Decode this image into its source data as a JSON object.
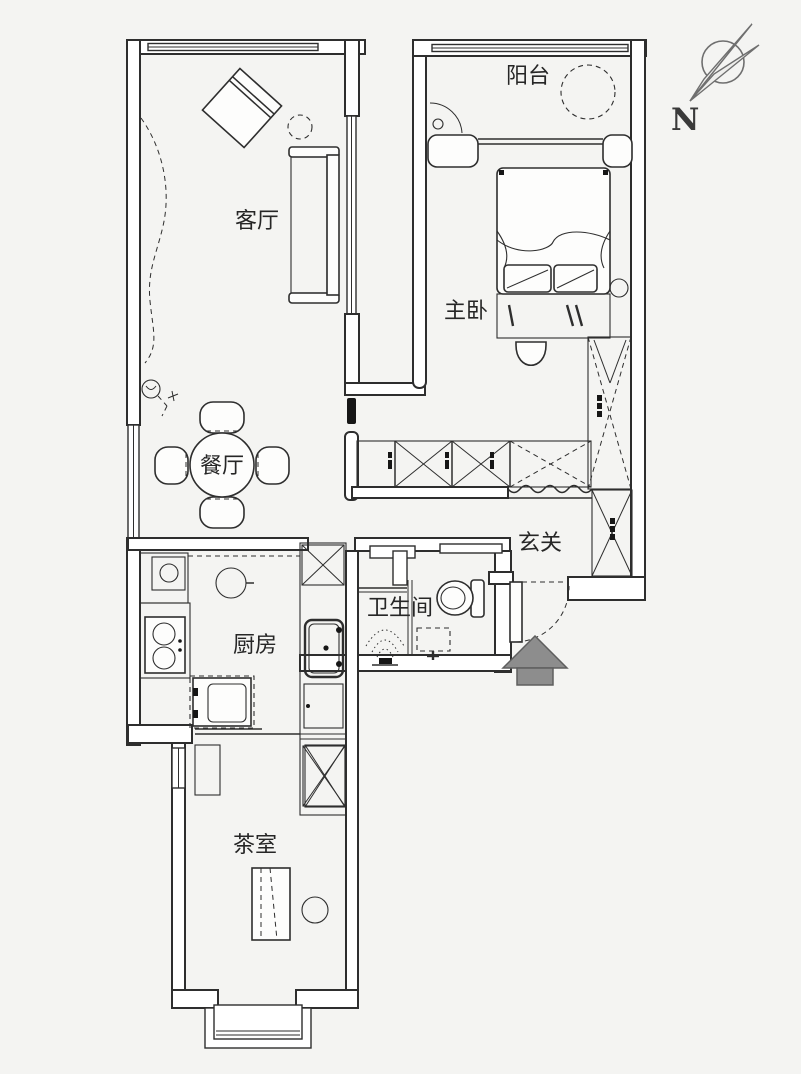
{
  "title": "apartment-floor-plan",
  "colors": {
    "background": "#f4f4f2",
    "line": "#2e2e2e",
    "compass_line": "#6f6f6f",
    "entry_arrow_fill": "#8d8d8d"
  },
  "compass": {
    "label": "N"
  },
  "rooms": {
    "balcony": {
      "label": "阳台"
    },
    "living": {
      "label": "客厅"
    },
    "master_bedroom": {
      "label": "主卧"
    },
    "dining": {
      "label": "餐厅"
    },
    "entry": {
      "label": "玄关"
    },
    "bathroom": {
      "label": "卫生间"
    },
    "kitchen": {
      "label": "厨房"
    },
    "tea_room": {
      "label": "茶室"
    }
  },
  "icons": [
    "compass-needle-icon",
    "entry-arrow-icon",
    "bed-icon",
    "sofa-icon",
    "armchair-icon",
    "dining-table-icon",
    "chair-icon",
    "wardrobe-icon",
    "shoe-cabinet-icon",
    "toilet-icon",
    "shower-icon",
    "bathmat-icon",
    "stove-icon",
    "sink-icon",
    "fridge-icon",
    "tea-table-icon",
    "stool-icon",
    "curtain-icon",
    "ceiling-lamp-icon",
    "radiator-icon",
    "door-swing-icon",
    "window-icon"
  ]
}
